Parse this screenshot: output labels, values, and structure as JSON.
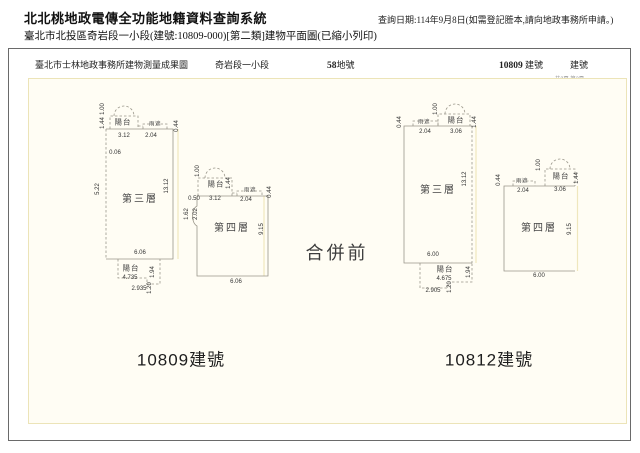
{
  "header": {
    "system_title": "北北桃地政電傳全功能地籍資料查詢系統",
    "query_date": "查詢日期:114年9月8日(如需登記謄本,請向地政事務所申請。)",
    "subtitle": "臺北市北投區奇岩段一小段(建號:10809-000)[第二類]建物平面圖(已縮小列印)"
  },
  "form": {
    "office_title": "臺北市士林地政事務所建物測量成果圖",
    "section_name": "奇岩段一小段",
    "land_number": "58",
    "land_number_suffix": "地號",
    "building_number": "10809",
    "building_number_suffix": "建號",
    "building_number_label": "建號",
    "page_info": "共2頁 第2頁"
  },
  "drawing": {
    "merge_status": "合併前",
    "left_building_label": "10809建號",
    "right_building_label": "10812建號",
    "colors": {
      "paper_fill": "#fffdf4",
      "paper_border": "#ece4b8",
      "plan_line": "#9a968a",
      "extension_line": "#efe7bd"
    },
    "dim_labels": [
      {
        "t": "1.00",
        "x": 74,
        "y": 30,
        "v": 1
      },
      {
        "t": "1.44",
        "x": 74,
        "y": 44,
        "v": 1
      },
      {
        "t": "陽台",
        "x": 94,
        "y": 43,
        "cls": "room"
      },
      {
        "t": "3.12",
        "x": 95,
        "y": 57
      },
      {
        "t": "雨遮",
        "x": 126,
        "y": 46,
        "cls": "tiny"
      },
      {
        "t": "2.04",
        "x": 122,
        "y": 57
      },
      {
        "t": "0.44",
        "x": 148,
        "y": 47,
        "v": 1
      },
      {
        "t": "0.06",
        "x": 86,
        "y": 74
      },
      {
        "t": "5.22",
        "x": 69,
        "y": 110,
        "v": 1
      },
      {
        "t": "13.12",
        "x": 138,
        "y": 107,
        "v": 1
      },
      {
        "t": "第三層",
        "x": 111,
        "y": 121,
        "cls": "floor"
      },
      {
        "t": "6.06",
        "x": 111,
        "y": 174
      },
      {
        "t": "陽台",
        "x": 102,
        "y": 189,
        "cls": "room"
      },
      {
        "t": "4.735",
        "x": 101,
        "y": 199
      },
      {
        "t": "1.94",
        "x": 124,
        "y": 193,
        "v": 1
      },
      {
        "t": "2.935",
        "x": 110,
        "y": 210
      },
      {
        "t": "1.20",
        "x": 121,
        "y": 209,
        "v": 1
      },
      {
        "t": "1.00",
        "x": 169,
        "y": 92,
        "v": 1
      },
      {
        "t": "陽台",
        "x": 187,
        "y": 105,
        "cls": "room"
      },
      {
        "t": "1.44",
        "x": 200,
        "y": 104,
        "v": 1
      },
      {
        "t": "3.12",
        "x": 186,
        "y": 120
      },
      {
        "t": "0.50",
        "x": 165,
        "y": 120
      },
      {
        "t": "雨遮",
        "x": 221,
        "y": 112,
        "cls": "tiny"
      },
      {
        "t": "2.04",
        "x": 217,
        "y": 121
      },
      {
        "t": "0.44",
        "x": 241,
        "y": 113,
        "v": 1
      },
      {
        "t": "1.62",
        "x": 158,
        "y": 135,
        "v": 1
      },
      {
        "t": "2.02",
        "x": 167,
        "y": 135,
        "v": 1
      },
      {
        "t": "第四層",
        "x": 203,
        "y": 150,
        "cls": "floor"
      },
      {
        "t": "9.15",
        "x": 233,
        "y": 150,
        "v": 1
      },
      {
        "t": "6.06",
        "x": 207,
        "y": 203
      },
      {
        "t": "0.44",
        "x": 371,
        "y": 43,
        "v": 1
      },
      {
        "t": "雨遮",
        "x": 395,
        "y": 44,
        "cls": "tiny"
      },
      {
        "t": "2.04",
        "x": 396,
        "y": 53
      },
      {
        "t": "1.00",
        "x": 407,
        "y": 30,
        "v": 1
      },
      {
        "t": "陽台",
        "x": 427,
        "y": 41,
        "cls": "room"
      },
      {
        "t": "3.06",
        "x": 427,
        "y": 53
      },
      {
        "t": "1.44",
        "x": 446,
        "y": 43,
        "v": 1
      },
      {
        "t": "13.12",
        "x": 436,
        "y": 100,
        "v": 1
      },
      {
        "t": "第三層",
        "x": 409,
        "y": 112,
        "cls": "floor"
      },
      {
        "t": "6.00",
        "x": 404,
        "y": 176
      },
      {
        "t": "陽台",
        "x": 416,
        "y": 190,
        "cls": "room"
      },
      {
        "t": "4.675",
        "x": 415,
        "y": 200
      },
      {
        "t": "1.94",
        "x": 440,
        "y": 193,
        "v": 1
      },
      {
        "t": "2.905",
        "x": 404,
        "y": 212
      },
      {
        "t": "1.20",
        "x": 421,
        "y": 208,
        "v": 1
      },
      {
        "t": "0.44",
        "x": 470,
        "y": 101,
        "v": 1
      },
      {
        "t": "雨遮",
        "x": 493,
        "y": 103,
        "cls": "tiny"
      },
      {
        "t": "2.04",
        "x": 494,
        "y": 112
      },
      {
        "t": "1.00",
        "x": 510,
        "y": 86,
        "v": 1
      },
      {
        "t": "陽台",
        "x": 532,
        "y": 97,
        "cls": "room"
      },
      {
        "t": "3.06",
        "x": 531,
        "y": 111
      },
      {
        "t": "1.44",
        "x": 548,
        "y": 99,
        "v": 1
      },
      {
        "t": "第四層",
        "x": 510,
        "y": 150,
        "cls": "floor"
      },
      {
        "t": "9.15",
        "x": 541,
        "y": 150,
        "v": 1
      },
      {
        "t": "6.00",
        "x": 510,
        "y": 197
      }
    ]
  }
}
